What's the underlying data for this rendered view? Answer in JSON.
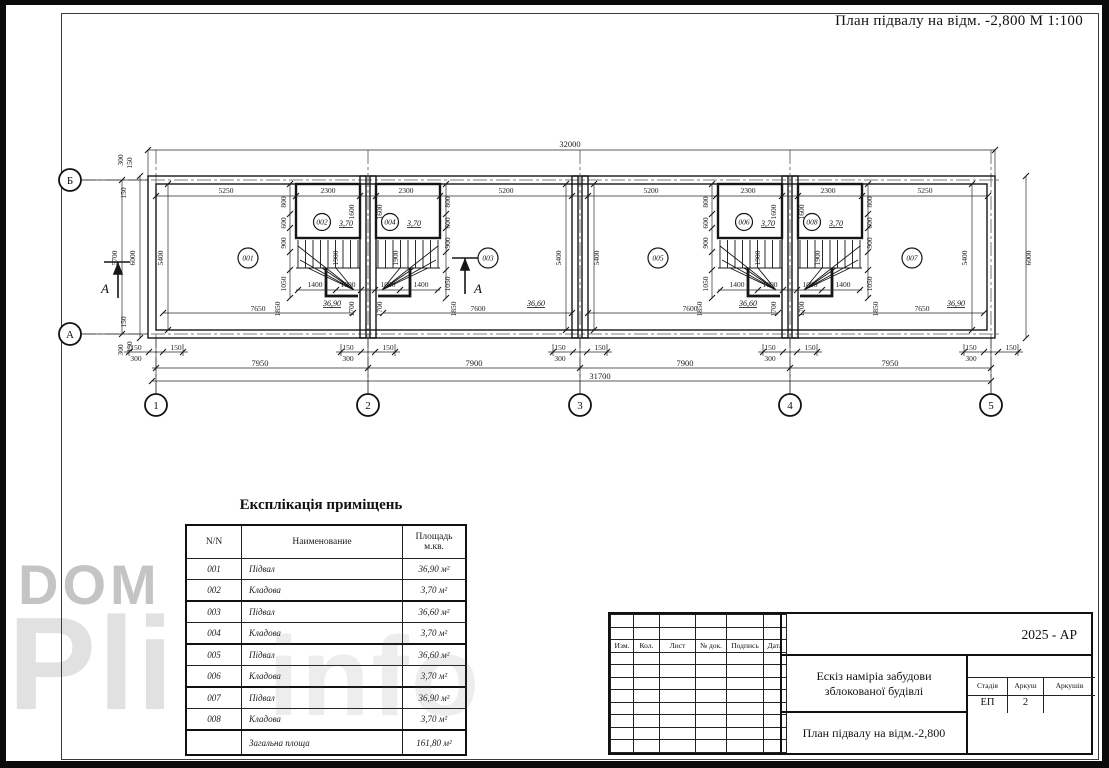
{
  "sheet_title": "План підвалу на відм. -2,800  М 1:100",
  "watermark": {
    "word1": "DOM",
    "word2": "Pli",
    "word3": "info"
  },
  "plan": {
    "dim_labels": [
      {
        "t": "32000",
        "x": 570,
        "y": 147,
        "b": 1
      },
      {
        "t": "5250",
        "x": 226,
        "y": 193
      },
      {
        "t": "2300",
        "x": 328,
        "y": 193
      },
      {
        "t": "2300",
        "x": 406,
        "y": 193
      },
      {
        "t": "5200",
        "x": 506,
        "y": 193
      },
      {
        "t": "5200",
        "x": 651,
        "y": 193
      },
      {
        "t": "2300",
        "x": 748,
        "y": 193
      },
      {
        "t": "2300",
        "x": 828,
        "y": 193
      },
      {
        "t": "5250",
        "x": 925,
        "y": 193
      },
      {
        "t": "800",
        "x": 286,
        "y": 202,
        "r": 1
      },
      {
        "t": "600",
        "x": 286,
        "y": 223,
        "r": 1
      },
      {
        "t": "900",
        "x": 286,
        "y": 243,
        "r": 1
      },
      {
        "t": "1050",
        "x": 286,
        "y": 284,
        "r": 1
      },
      {
        "t": "800",
        "x": 450,
        "y": 202,
        "r": 1
      },
      {
        "t": "600",
        "x": 450,
        "y": 223,
        "r": 1
      },
      {
        "t": "900",
        "x": 450,
        "y": 243,
        "r": 1
      },
      {
        "t": "1050",
        "x": 450,
        "y": 284,
        "r": 1
      },
      {
        "t": "1600",
        "x": 354,
        "y": 212,
        "r": 1
      },
      {
        "t": "1600",
        "x": 382,
        "y": 212,
        "r": 1
      },
      {
        "t": "1900",
        "x": 338,
        "y": 258,
        "r": 1
      },
      {
        "t": "1900",
        "x": 398,
        "y": 258,
        "r": 1
      },
      {
        "t": "1400",
        "x": 315,
        "y": 287
      },
      {
        "t": "1000",
        "x": 348,
        "y": 287
      },
      {
        "t": "1000",
        "x": 388,
        "y": 287
      },
      {
        "t": "1400",
        "x": 421,
        "y": 287
      },
      {
        "t": "1850",
        "x": 280,
        "y": 309,
        "r": 1
      },
      {
        "t": "1700",
        "x": 354,
        "y": 309,
        "r": 1
      },
      {
        "t": "1700",
        "x": 382,
        "y": 309,
        "r": 1
      },
      {
        "t": "1850",
        "x": 456,
        "y": 309,
        "r": 1
      },
      {
        "t": "800",
        "x": 708,
        "y": 202,
        "r": 1
      },
      {
        "t": "600",
        "x": 708,
        "y": 223,
        "r": 1
      },
      {
        "t": "900",
        "x": 708,
        "y": 243,
        "r": 1
      },
      {
        "t": "1050",
        "x": 708,
        "y": 284,
        "r": 1
      },
      {
        "t": "800",
        "x": 872,
        "y": 202,
        "r": 1
      },
      {
        "t": "600",
        "x": 872,
        "y": 223,
        "r": 1
      },
      {
        "t": "900",
        "x": 872,
        "y": 243,
        "r": 1
      },
      {
        "t": "1050",
        "x": 872,
        "y": 284,
        "r": 1
      },
      {
        "t": "1600",
        "x": 776,
        "y": 212,
        "r": 1
      },
      {
        "t": "1600",
        "x": 804,
        "y": 212,
        "r": 1
      },
      {
        "t": "1900",
        "x": 760,
        "y": 258,
        "r": 1
      },
      {
        "t": "1900",
        "x": 820,
        "y": 258,
        "r": 1
      },
      {
        "t": "1400",
        "x": 737,
        "y": 287
      },
      {
        "t": "1000",
        "x": 770,
        "y": 287
      },
      {
        "t": "1000",
        "x": 810,
        "y": 287
      },
      {
        "t": "1400",
        "x": 843,
        "y": 287
      },
      {
        "t": "1850",
        "x": 702,
        "y": 309,
        "r": 1
      },
      {
        "t": "1700",
        "x": 776,
        "y": 309,
        "r": 1
      },
      {
        "t": "1700",
        "x": 804,
        "y": 309,
        "r": 1
      },
      {
        "t": "1850",
        "x": 878,
        "y": 309,
        "r": 1
      },
      {
        "t": "5400",
        "x": 163,
        "y": 258,
        "r": 1
      },
      {
        "t": "5400",
        "x": 561,
        "y": 258,
        "r": 1
      },
      {
        "t": "5400",
        "x": 599,
        "y": 258,
        "r": 1
      },
      {
        "t": "5400",
        "x": 967,
        "y": 258,
        "r": 1
      },
      {
        "t": "5700",
        "x": 117,
        "y": 258,
        "r": 1
      },
      {
        "t": "6000",
        "x": 135,
        "y": 258,
        "r": 1
      },
      {
        "t": "6000",
        "x": 1031,
        "y": 258,
        "r": 1
      },
      {
        "t": "300",
        "x": 123,
        "y": 160,
        "r": 1
      },
      {
        "t": "150",
        "x": 132,
        "y": 163,
        "r": 1
      },
      {
        "t": "150",
        "x": 126,
        "y": 193,
        "r": 1
      },
      {
        "t": "150",
        "x": 126,
        "y": 322,
        "r": 1
      },
      {
        "t": "300",
        "x": 123,
        "y": 350,
        "r": 1
      },
      {
        "t": "150",
        "x": 132,
        "y": 347,
        "r": 1
      },
      {
        "t": "7650",
        "x": 258,
        "y": 311
      },
      {
        "t": "7600",
        "x": 478,
        "y": 311
      },
      {
        "t": "7600",
        "x": 690,
        "y": 311
      },
      {
        "t": "7650",
        "x": 922,
        "y": 311
      },
      {
        "t": "150",
        "x": 136,
        "y": 350
      },
      {
        "t": "150",
        "x": 176,
        "y": 350
      },
      {
        "t": "300",
        "x": 136,
        "y": 361
      },
      {
        "t": "150",
        "x": 348,
        "y": 350
      },
      {
        "t": "150",
        "x": 388,
        "y": 350
      },
      {
        "t": "300",
        "x": 348,
        "y": 361
      },
      {
        "t": "150",
        "x": 560,
        "y": 350
      },
      {
        "t": "150",
        "x": 600,
        "y": 350
      },
      {
        "t": "300",
        "x": 560,
        "y": 361
      },
      {
        "t": "150",
        "x": 770,
        "y": 350
      },
      {
        "t": "150",
        "x": 810,
        "y": 350
      },
      {
        "t": "300",
        "x": 770,
        "y": 361
      },
      {
        "t": "150",
        "x": 971,
        "y": 350
      },
      {
        "t": "150",
        "x": 1011,
        "y": 350
      },
      {
        "t": "300",
        "x": 971,
        "y": 361
      },
      {
        "t": "7950",
        "x": 260,
        "y": 366,
        "b": 1
      },
      {
        "t": "7900",
        "x": 474,
        "y": 366,
        "b": 1
      },
      {
        "t": "7900",
        "x": 685,
        "y": 366,
        "b": 1
      },
      {
        "t": "7950",
        "x": 890,
        "y": 366,
        "b": 1
      },
      {
        "t": "31700",
        "x": 600,
        "y": 379,
        "b": 1
      }
    ],
    "room_tags": [
      {
        "t": "001",
        "x": 248,
        "y": 258,
        "rad": 10
      },
      {
        "t": "003",
        "x": 488,
        "y": 258,
        "rad": 10
      },
      {
        "t": "005",
        "x": 658,
        "y": 258,
        "rad": 10
      },
      {
        "t": "007",
        "x": 912,
        "y": 258,
        "rad": 10
      },
      {
        "t": "002",
        "x": 322,
        "y": 222,
        "rad": 8.5
      },
      {
        "t": "004",
        "x": 390,
        "y": 222,
        "rad": 8.5
      },
      {
        "t": "006",
        "x": 744,
        "y": 222,
        "rad": 8.5
      },
      {
        "t": "008",
        "x": 812,
        "y": 222,
        "rad": 8.5
      }
    ],
    "room_areas": [
      {
        "t": "36,90",
        "x": 332,
        "y": 306
      },
      {
        "t": "36,60",
        "x": 536,
        "y": 306
      },
      {
        "t": "36,60",
        "x": 748,
        "y": 306
      },
      {
        "t": "36,90",
        "x": 956,
        "y": 306
      },
      {
        "t": "3,70",
        "x": 346,
        "y": 226
      },
      {
        "t": "3,70",
        "x": 414,
        "y": 226
      },
      {
        "t": "3,70",
        "x": 768,
        "y": 226
      },
      {
        "t": "3,70",
        "x": 836,
        "y": 226
      }
    ],
    "axis_bubbles": [
      {
        "t": "1",
        "x": 156,
        "y": 405
      },
      {
        "t": "2",
        "x": 368,
        "y": 405
      },
      {
        "t": "3",
        "x": 580,
        "y": 405
      },
      {
        "t": "4",
        "x": 790,
        "y": 405
      },
      {
        "t": "5",
        "x": 991,
        "y": 405
      },
      {
        "t": "Б",
        "x": 70,
        "y": 180
      },
      {
        "t": "А",
        "x": 70,
        "y": 334
      }
    ],
    "section_labels": [
      {
        "t": "А",
        "x": 101,
        "y": 293
      },
      {
        "t": "А",
        "x": 474,
        "y": 293
      }
    ]
  },
  "explication": {
    "title": "Експлікація приміщень",
    "col_nn": "N/N",
    "col_name": "Наименование",
    "col_area1": "Площадь",
    "col_area2": "м.кв.",
    "rows": [
      [
        "001",
        "Підвал",
        "36,90 м²"
      ],
      [
        "002",
        "Кладова",
        "3,70 м²"
      ],
      [
        "003",
        "Підвал",
        "36,60 м²"
      ],
      [
        "004",
        "Кладова",
        "3,70 м²"
      ],
      [
        "005",
        "Підвал",
        "36,60 м²"
      ],
      [
        "006",
        "Кладова",
        "3,70 м²"
      ],
      [
        "007",
        "Підвал",
        "36,90 м²"
      ],
      [
        "008",
        "Кладова",
        "3,70 м²"
      ]
    ],
    "total_label": "Загальна площа",
    "total_value": "161,80 м²"
  },
  "titleblock": {
    "code": "2025 - АР",
    "small_cols": [
      "Изм.",
      "Кол.",
      "Лист",
      "№ док.",
      "Подпись",
      "Дата"
    ],
    "project_line1": "Ескіз наміріа забудови",
    "project_line2": "зблокованої будівлі",
    "stage_label": "Стадія",
    "sheet_label": "Аркуш",
    "sheets_label": "Аркушів",
    "stage": "ЕП",
    "sheet": "2",
    "sheets": "",
    "drawing_title": "План підвалу на відм.-2,800"
  }
}
